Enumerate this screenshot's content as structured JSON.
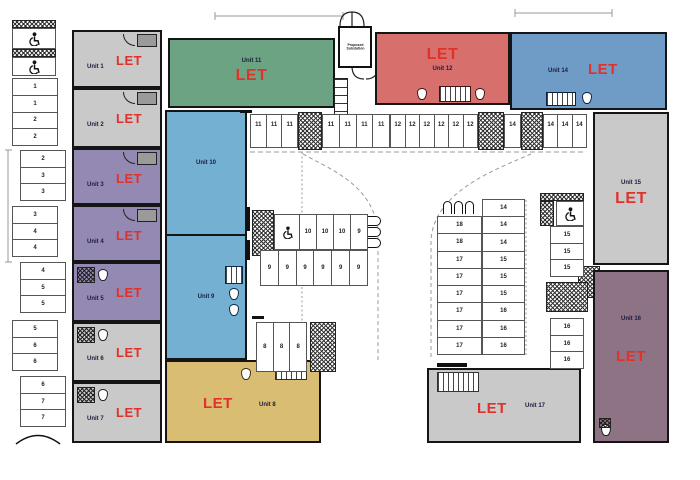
{
  "title": "Estate letting floor plan",
  "labels": {
    "let": "LET"
  },
  "colors": {
    "let_red": "#e0312a",
    "unit_gray": "#c9c9c9",
    "unit_purple": "#9489b2",
    "unit_green": "#6ca483",
    "unit_red": "#d7706d",
    "unit_steel_blue": "#6f9cc6",
    "unit_light_blue": "#74b0d2",
    "unit_yellow": "#d9bd72",
    "unit_mauve": "#8d7384",
    "wall": "#151515"
  },
  "units": {
    "u1": {
      "name": "Unit 1",
      "status": "LET"
    },
    "u2": {
      "name": "Unit 2",
      "status": "LET"
    },
    "u3": {
      "name": "Unit 3",
      "status": "LET"
    },
    "u4": {
      "name": "Unit 4",
      "status": "LET"
    },
    "u5": {
      "name": "Unit 5",
      "status": "LET"
    },
    "u6": {
      "name": "Unit 6",
      "status": "LET"
    },
    "u7": {
      "name": "Unit 7",
      "status": "LET"
    },
    "u8": {
      "name": "Unit 8",
      "status": "LET"
    },
    "u9": {
      "name": "Unit 9",
      "status": ""
    },
    "u10": {
      "name": "Unit 10",
      "status": ""
    },
    "u11": {
      "name": "Unit 11",
      "status": "LET"
    },
    "u12": {
      "name": "Unit 12",
      "status": "LET"
    },
    "u14": {
      "name": "Unit 14",
      "status": "LET"
    },
    "u15": {
      "name": "Unit 15",
      "status": "LET"
    },
    "u16": {
      "name": "Unit 16",
      "status": "LET"
    },
    "u17": {
      "name": "Unit 17",
      "status": "LET"
    }
  },
  "substation": {
    "line1": "Proposed",
    "line2": "Substation"
  },
  "parking": {
    "left": {
      "g1": [
        "1",
        "1",
        "2",
        "2"
      ],
      "g2": [
        "2",
        "3",
        "3"
      ],
      "g3": [
        "3",
        "4",
        "4"
      ],
      "g4": [
        "4",
        "5",
        "5"
      ],
      "g5": [
        "5",
        "6",
        "6"
      ],
      "g6": [
        "6",
        "7",
        "7"
      ]
    },
    "top": {
      "a": [
        "11",
        "11",
        "11"
      ],
      "b": [
        "11",
        "11",
        "11",
        "11"
      ],
      "c": [
        "12",
        "12",
        "12",
        "12",
        "12",
        "12"
      ],
      "d": [
        "14"
      ],
      "e": [
        "14",
        "14",
        "14"
      ]
    },
    "center_left": {
      "r1": [
        "10",
        "10",
        "10",
        "9"
      ],
      "r2": [
        "9",
        "9",
        "9",
        "9",
        "9",
        "9"
      ]
    },
    "block8": [
      "8",
      "8",
      "8"
    ],
    "center_right": {
      "left_col": [
        "18",
        "18",
        "17",
        "17",
        "17",
        "17",
        "17",
        "17"
      ],
      "right_col": [
        "14",
        "14",
        "14",
        "15",
        "15",
        "15",
        "16",
        "16",
        "16"
      ]
    },
    "right_col": {
      "g15": [
        "15",
        "15",
        "15"
      ],
      "g16": [
        "16",
        "16",
        "16"
      ]
    }
  }
}
